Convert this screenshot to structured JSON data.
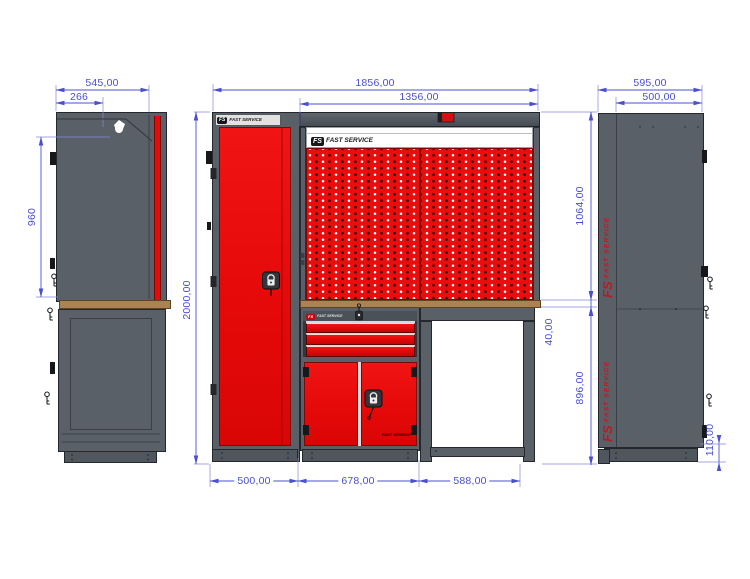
{
  "drawing": {
    "brand": {
      "abbr": "FS",
      "name": "FAST SERVICE"
    },
    "dims": {
      "left_total_depth": "545,00",
      "left_top_bracket": "266",
      "left_upper_height": "960",
      "front_total_width": "1856,00",
      "front_panel_width": "1356,00",
      "front_total_height": "2000,00",
      "front_panel_height": "1064,00",
      "front_worktop_thickness": "40,00",
      "front_lower_height": "896,00",
      "front_cabinet_width": "500,00",
      "front_middle_width": "678,00",
      "front_bench_width": "588,00",
      "right_total_depth": "595,00",
      "right_body_depth": "500,00",
      "right_base_height": "110,00"
    },
    "colors": {
      "red": "#e80d0d",
      "gray": "#5a6068",
      "worktop": "#ab8252",
      "dimension_blue": "#4a4fd0"
    }
  }
}
